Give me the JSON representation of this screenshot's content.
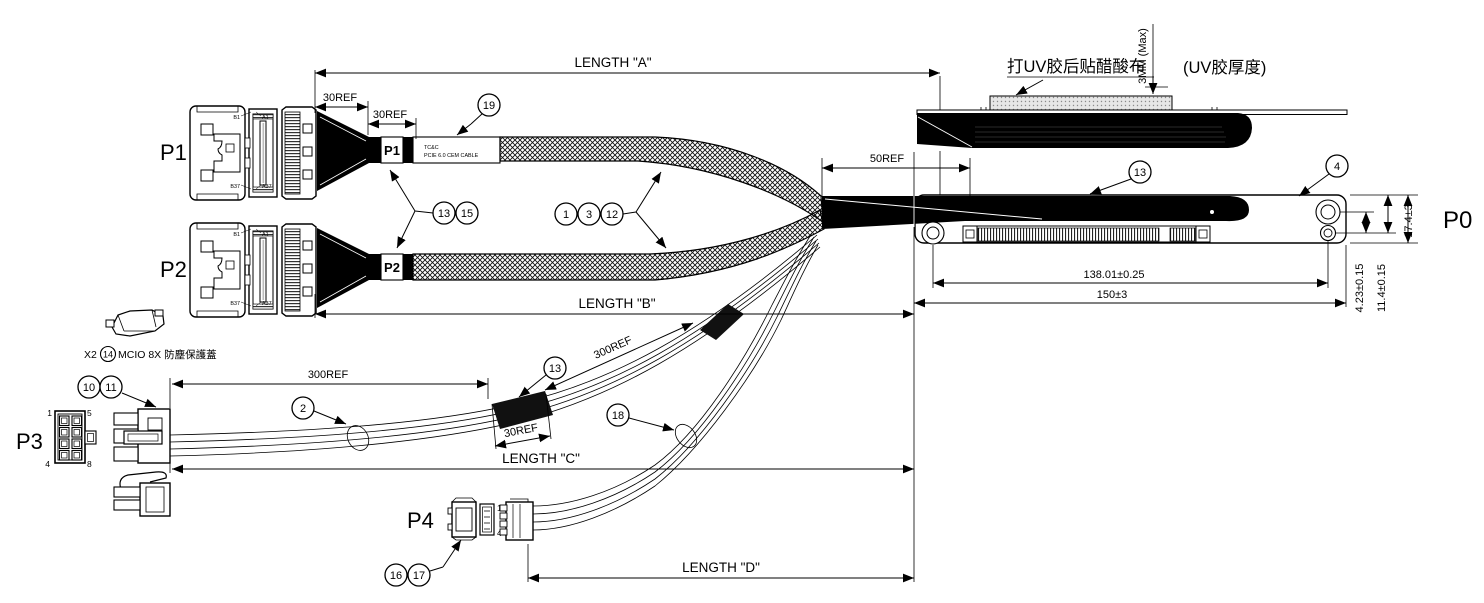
{
  "connectors": {
    "p0": "P0",
    "p1": "P1",
    "p2": "P2",
    "p3": "P3",
    "p4": "P4"
  },
  "dimensions": {
    "length_a": "LENGTH \"A\"",
    "length_b": "LENGTH \"B\"",
    "length_c": "LENGTH \"C\"",
    "length_d": "LENGTH \"D\"",
    "ref30": "30REF",
    "ref50": "50REF",
    "ref300": "300REF",
    "hole_span": "138.01±0.25",
    "board_len": "150±3",
    "board_height": "17.4±3",
    "hole_offset_a": "4.23±0.15",
    "hole_offset_b": "11.4±0.15",
    "uv_max": "3MM (Max)"
  },
  "notes": {
    "uv_note": "打UV胶后贴醋酸布",
    "uv_thickness": "(UV胶厚度)",
    "cap_qty": "X2",
    "cap_label": "MCIO 8X 防塵保護蓋"
  },
  "cable_label": {
    "brand": "TC&C",
    "product": "PCIE 6.0 CEM CABLE"
  },
  "balloons": {
    "n1": "1",
    "n2": "2",
    "n3": "3",
    "n4": "4",
    "n10": "10",
    "n11": "11",
    "n12": "12",
    "n13": "13",
    "n14": "14",
    "n15": "15",
    "n16": "16",
    "n17": "17",
    "n18": "18",
    "n19": "19"
  },
  "pin_labels": {
    "b1": "B1",
    "a1": "A1",
    "b37": "B37",
    "a37": "A37",
    "p3_1": "1",
    "p3_5": "5",
    "p3_4": "4",
    "p3_8": "8",
    "p4_1": "1",
    "p4_4": "4"
  }
}
